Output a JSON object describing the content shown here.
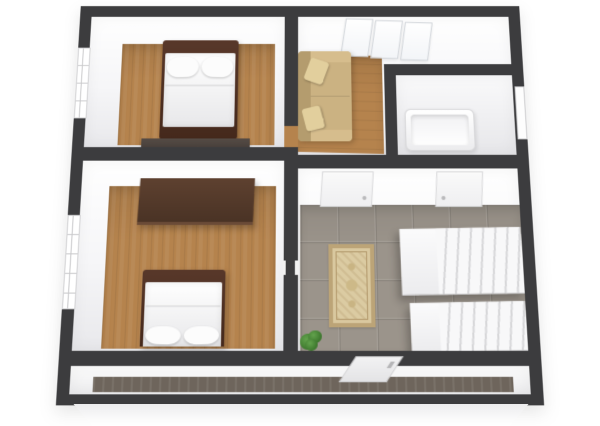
{
  "scene": {
    "type": "3d-floor-plan-render",
    "view": "top-down-perspective",
    "has_text": false
  },
  "colors": {
    "background": "#ffffff",
    "outer-wall": "#3c3c3e",
    "wall-face": "#f4f4f6",
    "wood-floor": "#b5834d",
    "tile-floor": "#9b948b",
    "bed-frame": "#45291c",
    "bedding": "#f5f5f5",
    "wardrobe": "#4a3325",
    "dresser": "#49413c",
    "sofa": "#cbb282",
    "rug": "#d9c89f",
    "rug-border": "#bca477",
    "stairs": "#f2f2f3",
    "plant": "#4c8a3c",
    "balcony-floor": "#6e655c",
    "plinth": "#fbfbfb"
  },
  "rooms": [
    {
      "id": "bedroom-1",
      "label": "upper-left bedroom with double bed, wood floor",
      "floor": "wood"
    },
    {
      "id": "living-room",
      "label": "upper-right living room with beige sofa and triple window",
      "floor": "wood"
    },
    {
      "id": "bathroom",
      "label": "small bathroom with bathtub",
      "floor": "light"
    },
    {
      "id": "bedroom-2",
      "label": "lower-left bedroom with double bed and wardrobe",
      "floor": "wood"
    },
    {
      "id": "hallway",
      "label": "tiled hallway with oriental rug, plant and staircase",
      "floor": "tile"
    },
    {
      "id": "balcony",
      "label": "balcony along the bottom with dark wood deck",
      "floor": "dark-wood"
    }
  ],
  "furniture": [
    {
      "id": "bed-1",
      "room": "bedroom-1",
      "type": "double-bed",
      "label": "double bed, dark frame, white bedding, two pillows at head"
    },
    {
      "id": "dresser-1",
      "room": "bedroom-1",
      "type": "low-dresser",
      "label": "low dark dresser against south wall"
    },
    {
      "id": "sofa-1",
      "room": "living-room",
      "type": "sofa",
      "label": "beige three-seat sofa with two throw pillows"
    },
    {
      "id": "bathtub-1",
      "room": "bathroom",
      "type": "bathtub",
      "label": "white bathtub"
    },
    {
      "id": "wardrobe-1",
      "room": "bedroom-2",
      "type": "wardrobe",
      "label": "dark brown wardrobe against north wall"
    },
    {
      "id": "bed-2",
      "room": "bedroom-2",
      "type": "double-bed",
      "label": "double bed, pillows toward balcony"
    },
    {
      "id": "rug-1",
      "room": "hallway",
      "type": "oriental-rug",
      "label": "beige ornamental rug"
    },
    {
      "id": "stairs-upper",
      "room": "hallway",
      "type": "stair-flight",
      "label": "upper white stair flight with landing"
    },
    {
      "id": "stairs-lower",
      "room": "hallway",
      "type": "stair-flight",
      "label": "lower white stair flight"
    },
    {
      "id": "plant-1",
      "room": "hallway",
      "type": "potted-plant",
      "label": "green plant in corner"
    }
  ],
  "openings": {
    "windows": [
      {
        "id": "window-bedroom-1",
        "wall": "left",
        "label": "window in left wall of bedroom 1"
      },
      {
        "id": "window-bedroom-2",
        "wall": "left",
        "label": "window in left wall of bedroom 2"
      },
      {
        "id": "window-living-room",
        "wall": "top",
        "panes": 3,
        "label": "three-pane window in top wall of living room"
      }
    ],
    "doors": [
      {
        "id": "door-hallway-left",
        "label": "white door in hallway north wall (left)"
      },
      {
        "id": "door-hallway-right",
        "label": "white door in hallway north wall (right)"
      },
      {
        "id": "door-bathroom",
        "label": "door in bathroom right wall"
      },
      {
        "id": "door-balcony",
        "label": "door from hallway to balcony"
      },
      {
        "id": "doorway-bedroom1-living",
        "label": "open doorway in center wall between bedroom 1 and living room"
      }
    ]
  }
}
